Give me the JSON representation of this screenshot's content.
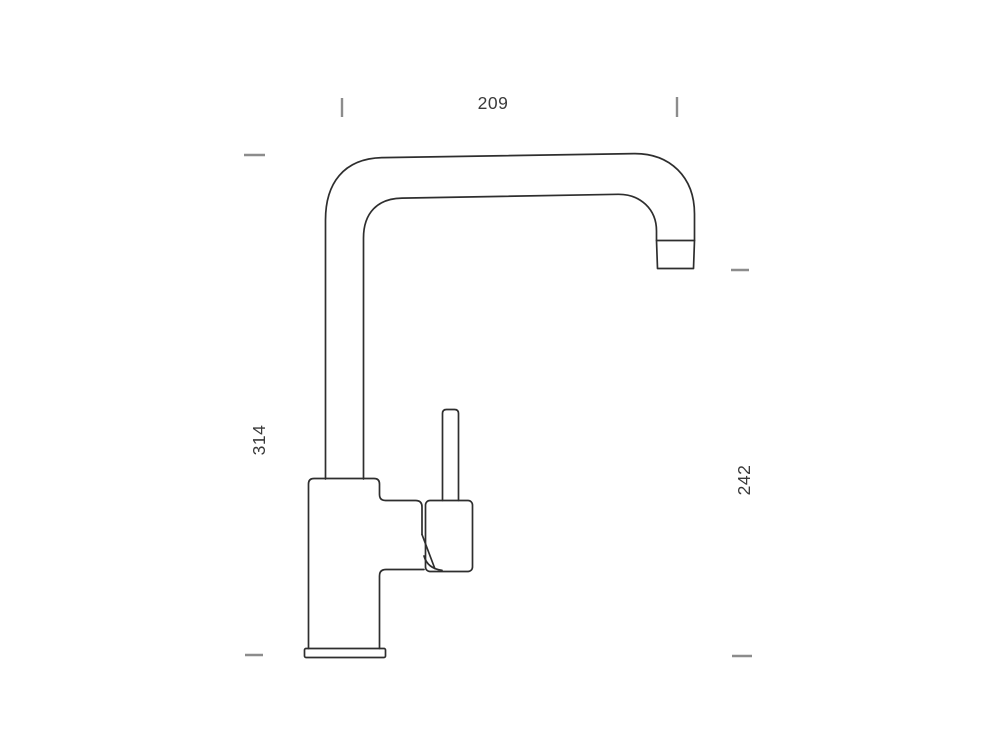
{
  "diagram": {
    "type": "technical-drawing",
    "subject": "kitchen-faucet-side-view",
    "dimensions": [
      {
        "name": "spout-reach-width",
        "value": "209",
        "orientation": "horizontal-top"
      },
      {
        "name": "overall-height",
        "value": "314",
        "orientation": "vertical-left"
      },
      {
        "name": "outlet-height",
        "value": "242",
        "orientation": "vertical-right"
      }
    ]
  },
  "colors": {
    "background": "#ffffff",
    "line": "#2e2e2e",
    "tick": "#8c8c8c",
    "label": "#3a3a3a"
  }
}
